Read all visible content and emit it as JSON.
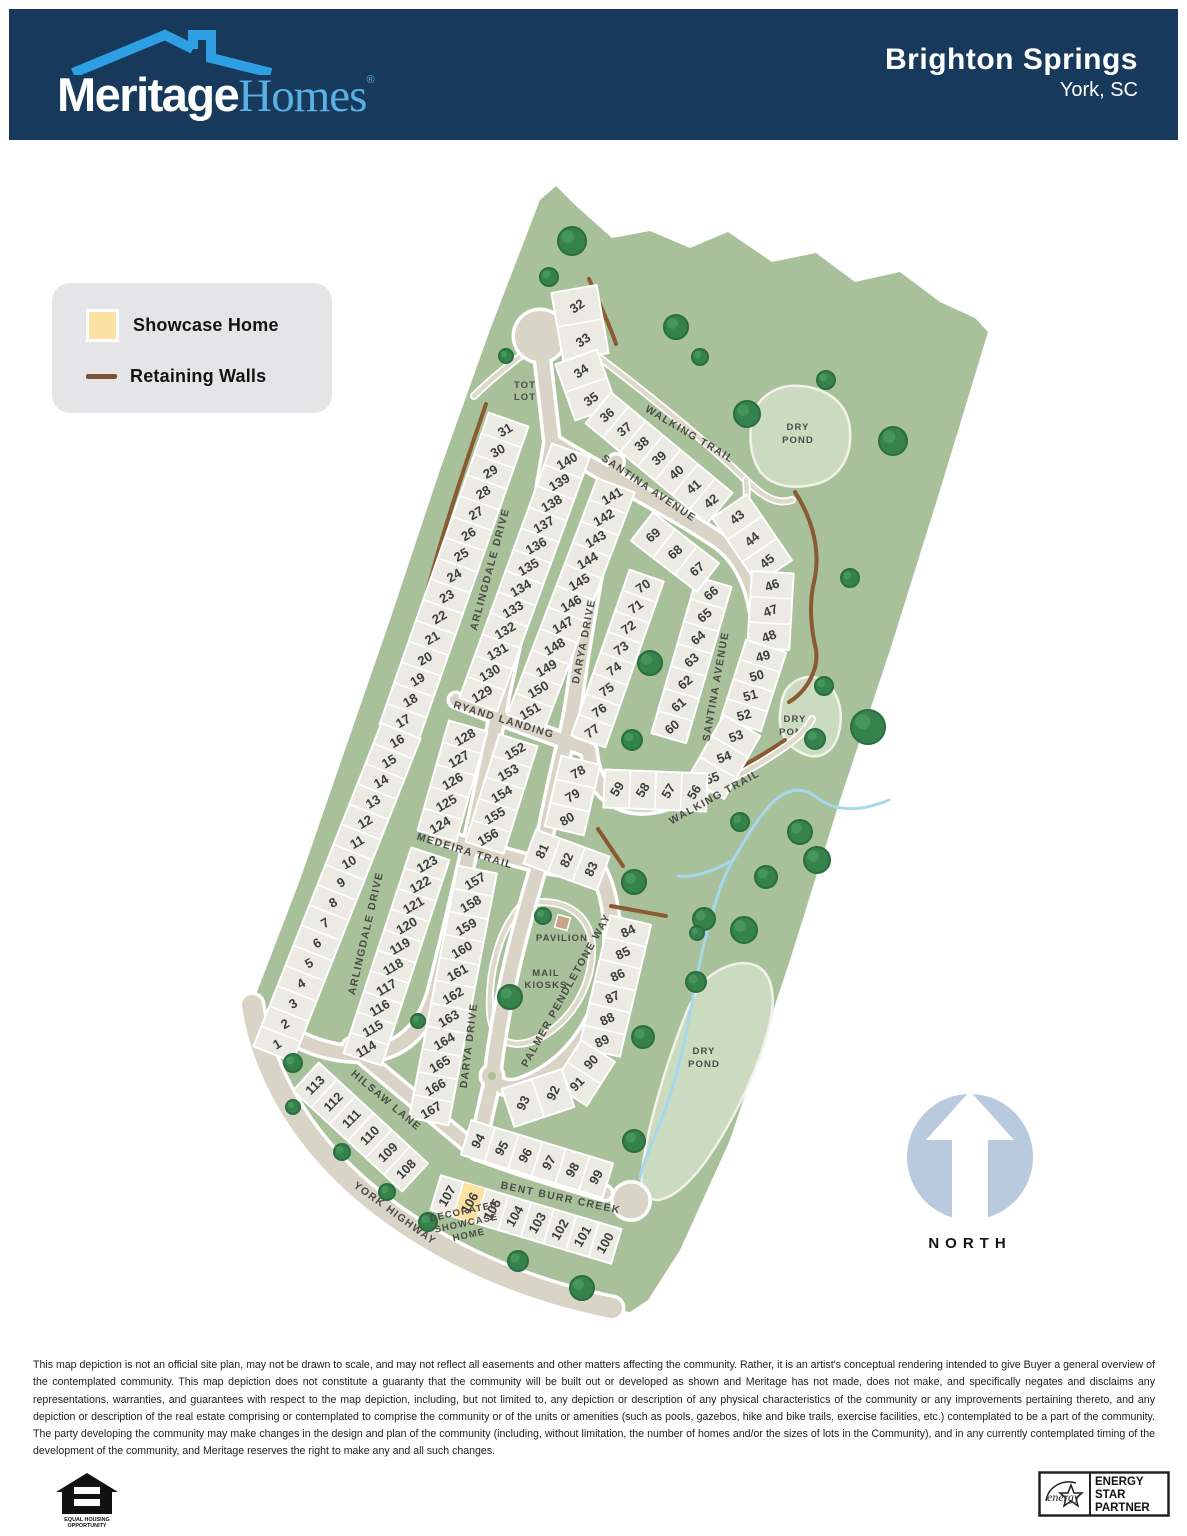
{
  "header": {
    "brand_bold": "Meritage",
    "brand_serif": "Homes",
    "brand_reg": "®",
    "community": "Brighton Springs",
    "location": "York, SC"
  },
  "legend": {
    "showcase_label": "Showcase Home",
    "walls_label": "Retaining Walls"
  },
  "north_label": "NORTH",
  "disclaimer": "This map depiction is not an official site plan, may not be drawn to scale, and may not reflect all easements and other matters affecting the community. Rather, it is an artist's conceptual rendering intended to give Buyer a general overview of the contemplated community. This map depiction does not constitute a guaranty that the community will be built out or developed as shown and Meritage has not made, does not make, and specifically negates and disclaims any representations, warranties, and guarantees with respect to the map depiction, including, but not limited to, any depiction or description of any physical characteristics of the community or any improvements pertaining thereto, and any depiction or description of the real estate comprising or contemplated to comprise the community or of the units or amenities (such as pools, gazebos, hike and bike trails, exercise facilities, etc.) contemplated to be a part of the community. The party developing the community may make changes in the design and plan of the community (including, without limitation, the number of homes and/or the sizes of lots in the Community), and in any currently contemplated timing of the development of the community, and Meritage reserves the right to make any and all such changes.",
  "footer": {
    "eho_line1": "EQUAL HOUSING",
    "eho_line2": "OPPORTUNITY",
    "estar_script": "energy",
    "estar_lines": [
      "ENERGY",
      "STAR",
      "PARTNER"
    ]
  },
  "colors": {
    "header_navy": "#17395c",
    "roof_blue": "#2d9fe2",
    "green": "#a8c19a",
    "pond": "#cbdbbf",
    "pond_edge": "#f3f2ea",
    "road": "#d9d4c5",
    "road_edge": "#ffffff",
    "lot": "#ebeae3",
    "lot_edge": "#ffffff",
    "wall": "#8a5a33",
    "creek": "#a5d8ec",
    "tree": "#35824d",
    "tree_edge": "#2a6e40",
    "showcase": "#fbe2a2",
    "north_circle": "#b9cadf",
    "pavilion": "#c9a486"
  },
  "map": {
    "boundary": [
      [
        556,
        186
      ],
      [
        575,
        205
      ],
      [
        612,
        238
      ],
      [
        650,
        231
      ],
      [
        690,
        248
      ],
      [
        728,
        232
      ],
      [
        772,
        262
      ],
      [
        816,
        253
      ],
      [
        855,
        282
      ],
      [
        900,
        272
      ],
      [
        940,
        302
      ],
      [
        975,
        318
      ],
      [
        988,
        332
      ],
      [
        940,
        490
      ],
      [
        890,
        650
      ],
      [
        840,
        800
      ],
      [
        790,
        960
      ],
      [
        730,
        1140
      ],
      [
        680,
        1250
      ],
      [
        648,
        1300
      ],
      [
        630,
        1312
      ],
      [
        560,
        1300
      ],
      [
        470,
        1256
      ],
      [
        390,
        1204
      ],
      [
        328,
        1152
      ],
      [
        282,
        1092
      ],
      [
        256,
        1028
      ],
      [
        252,
        1005
      ],
      [
        300,
        880
      ],
      [
        345,
        750
      ],
      [
        390,
        620
      ],
      [
        440,
        470
      ],
      [
        490,
        330
      ],
      [
        540,
        200
      ]
    ],
    "ponds": [
      {
        "d": "M752,420 C756,396 778,384 800,386 C826,388 848,402 850,430 C852,456 840,478 816,484 C792,490 768,486 758,468 C750,454 749,436 752,420 Z",
        "label": [
          "DRY",
          "POND"
        ],
        "lx": 798,
        "ly": 430
      },
      {
        "d": "M786,690 C796,676 816,672 828,684 C840,696 844,716 838,736 C832,754 818,760 804,754 C788,748 778,732 780,714 C781,705 782,696 786,690 Z",
        "label": [
          "DRY",
          "POND"
        ],
        "lx": 795,
        "ly": 722
      },
      {
        "d": "M700,986 C715,968 740,958 757,966 C772,974 776,996 770,1022 C760,1065 738,1112 712,1152 C695,1178 675,1198 658,1200 C646,1200 640,1190 642,1172 C646,1135 660,1085 676,1040 C683,1020 690,1002 700,986 Z",
        "label": [
          "DRY",
          "POND"
        ],
        "lx": 704,
        "ly": 1054
      }
    ],
    "creeks": [
      "M889,800 C860,812 835,812 816,797 C800,785 784,790 770,805 C755,822 745,840 733,860 C720,883 713,910 705,940 C697,972 692,1005 685,1038 C678,1072 668,1105 654,1138 C648,1152 643,1165 640,1178",
      "M733,860 C712,872 694,878 678,876"
    ],
    "trails": [
      "M600,358 C650,396 700,436 746,480 C763,497 777,505 792,500",
      "M746,480 C748,497 746,510 740,521",
      "M640,812 C688,801 738,780 786,746 C800,736 808,727 812,719",
      "M522,355 C505,368 490,380 474,396",
      "M522,905 C560,895 590,912 592,945 C594,985 570,1025 535,1040 C510,1050 492,1040 490,1012 C488,975 498,930 522,905"
    ],
    "roads": [
      {
        "d": "M252,1005 C262,1072 300,1136 356,1186 C420,1243 510,1288 612,1308",
        "w": 20
      },
      {
        "d": "M540,338 L552,442 C540,520 522,600 502,692 C484,786 462,888 438,982 C430,1020 410,1045 380,1052 C350,1058 320,1050 300,1040",
        "w": 13
      },
      {
        "d": "M552,442 C610,478 670,508 718,540 C752,564 764,612 759,666 C753,718 728,764 688,791 C660,809 628,812 606,792 C594,780 590,765 589,751",
        "w": 13
      },
      {
        "d": "M616,462 C600,540 585,620 574,700 C570,725 566,742 562,757 C552,800 546,830 540,862 C522,922 506,982 497,1042 C494,1060 493,1070 493,1078 L483,1122 L477,1152",
        "w": 13
      },
      {
        "d": "M456,700 C500,718 546,734 589,750",
        "w": 12
      },
      {
        "d": "M438,836 C475,847 510,858 541,865 C562,869 582,871 599,872",
        "w": 12
      },
      {
        "d": "M599,872 C614,903 617,948 604,994 C590,1040 560,1072 521,1086 C509,1090 499,1087 493,1080",
        "w": 13
      },
      {
        "d": "M350,1046 L477,1152",
        "w": 12
      },
      {
        "d": "M477,1152 C520,1168 560,1180 605,1193",
        "w": 12
      }
    ],
    "culdesacs": [
      {
        "cx": 540,
        "cy": 336,
        "r": 25
      },
      {
        "cx": 631,
        "cy": 1201,
        "r": 17.5
      },
      {
        "cx": 492,
        "cy": 1076,
        "r": 10,
        "hole": 4
      }
    ],
    "walls": [
      "M589,279 C600,305 611,328 616,344",
      "M486,404 C458,485 432,565 414,645 C398,710 377,790 353,848 L331,878",
      "M795,492 C813,520 821,552 814,582 C809,603 811,628 816,650 C819,670 806,692 789,702",
      "M640,806 C688,794 737,773 785,740",
      "M598,829 L623,866",
      "M611,906 L666,916"
    ],
    "strips": [
      {
        "lots": [
          "32",
          "33"
        ],
        "x1": 577,
        "y1": 306,
        "x2": 583,
        "y2": 340,
        "w": 46,
        "ang": -35
      },
      {
        "lots": [
          "34",
          "35"
        ],
        "x1": 581,
        "y1": 371,
        "x2": 591,
        "y2": 399,
        "w": 44,
        "ang": -35
      },
      {
        "lots": [
          "36",
          "37",
          "38",
          "39",
          "40",
          "41",
          "42"
        ],
        "x1": 607,
        "y1": 415,
        "x2": 711,
        "y2": 501,
        "w": 40,
        "ang": -40
      },
      {
        "lots": [
          "43",
          "44",
          "45"
        ],
        "x1": 737,
        "y1": 517,
        "x2": 767,
        "y2": 561,
        "w": 42,
        "ang": -40
      },
      {
        "lots": [
          "46",
          "47",
          "48"
        ],
        "x1": 772,
        "y1": 585,
        "x2": 769,
        "y2": 636,
        "w": 42,
        "ang": -20
      },
      {
        "lots": [
          "49",
          "50",
          "51",
          "52"
        ],
        "x1": 763,
        "y1": 656,
        "x2": 744,
        "y2": 715,
        "w": 42,
        "ang": -15
      },
      {
        "lots": [
          "53",
          "54",
          "55"
        ],
        "x1": 736,
        "y1": 736,
        "x2": 712,
        "y2": 778,
        "w": 42,
        "ang": -20
      },
      {
        "lots": [
          "56",
          "57",
          "58",
          "59"
        ],
        "x1": 694,
        "y1": 792,
        "x2": 617,
        "y2": 789,
        "w": 38,
        "ang": -58
      },
      {
        "lots": [
          "66",
          "65",
          "64",
          "63",
          "62",
          "61",
          "60"
        ],
        "x1": 711,
        "y1": 593,
        "x2": 672,
        "y2": 727,
        "w": 36,
        "ang": -40
      },
      {
        "lots": [
          "69",
          "68",
          "67"
        ],
        "x1": 653,
        "y1": 535,
        "x2": 697,
        "y2": 569,
        "w": 36,
        "ang": -40
      },
      {
        "lots": [
          "70",
          "71",
          "72",
          "73",
          "74",
          "75",
          "76",
          "77"
        ],
        "x1": 643,
        "y1": 586,
        "x2": 592,
        "y2": 731,
        "w": 36,
        "ang": -35
      },
      {
        "lots": [
          "140",
          "139",
          "138",
          "137",
          "136",
          "135",
          "134",
          "133",
          "132",
          "131",
          "130",
          "129"
        ],
        "x1": 567,
        "y1": 461,
        "x2": 482,
        "y2": 694,
        "w": 40,
        "ang": -30
      },
      {
        "lots": [
          "141",
          "142",
          "143",
          "144",
          "145",
          "146",
          "147",
          "148",
          "149",
          "150",
          "151"
        ],
        "x1": 612,
        "y1": 496,
        "x2": 530,
        "y2": 711,
        "w": 40,
        "ang": -30
      },
      {
        "lots": [
          "31",
          "30",
          "29",
          "28",
          "27",
          "26",
          "25",
          "24",
          "23",
          "22",
          "21",
          "20",
          "19",
          "18",
          "17"
        ],
        "x1": 505,
        "y1": 430,
        "x2": 403,
        "y2": 721,
        "w": 42,
        "ang": -30
      },
      {
        "lots": [
          "16",
          "15",
          "14",
          "13",
          "12",
          "11",
          "10",
          "9",
          "8",
          "7",
          "6",
          "5",
          "4",
          "3",
          "2",
          "1"
        ],
        "x1": 397,
        "y1": 741,
        "x2": 277,
        "y2": 1044,
        "w": 42,
        "ang": -30
      },
      {
        "lots": [
          "128",
          "127",
          "126",
          "125",
          "124"
        ],
        "x1": 465,
        "y1": 737,
        "x2": 440,
        "y2": 825,
        "w": 40,
        "ang": -30
      },
      {
        "lots": [
          "152",
          "153",
          "154",
          "155",
          "156"
        ],
        "x1": 515,
        "y1": 751,
        "x2": 488,
        "y2": 837,
        "w": 40,
        "ang": -30
      },
      {
        "lots": [
          "123",
          "122",
          "121",
          "120",
          "119",
          "118",
          "117",
          "116",
          "115",
          "114"
        ],
        "x1": 427,
        "y1": 864,
        "x2": 366,
        "y2": 1049,
        "w": 40,
        "ang": -30
      },
      {
        "lots": [
          "157",
          "158",
          "159",
          "160",
          "161",
          "162",
          "163",
          "164",
          "165",
          "166",
          "167"
        ],
        "x1": 475,
        "y1": 881,
        "x2": 431,
        "y2": 1110,
        "w": 40,
        "ang": -30
      },
      {
        "lots": [
          "78",
          "79",
          "80"
        ],
        "x1": 578,
        "y1": 772,
        "x2": 567,
        "y2": 819,
        "w": 40,
        "ang": -30
      },
      {
        "lots": [
          "81",
          "82",
          "83"
        ],
        "x1": 542,
        "y1": 851,
        "x2": 591,
        "y2": 869,
        "w": 36,
        "ang": -65
      },
      {
        "lots": [
          "84",
          "85",
          "86",
          "87",
          "88",
          "89"
        ],
        "x1": 628,
        "y1": 931,
        "x2": 602,
        "y2": 1041,
        "w": 42,
        "ang": -25
      },
      {
        "lots": [
          "90",
          "91"
        ],
        "x1": 591,
        "y1": 1062,
        "x2": 577,
        "y2": 1084,
        "w": 40,
        "ang": -45
      },
      {
        "lots": [
          "92",
          "93"
        ],
        "x1": 553,
        "y1": 1093,
        "x2": 523,
        "y2": 1103,
        "w": 40,
        "ang": -65
      },
      {
        "lots": [
          "94",
          "95",
          "96",
          "97",
          "98",
          "99"
        ],
        "x1": 478,
        "y1": 1141,
        "x2": 596,
        "y2": 1177,
        "w": 36,
        "ang": -60
      },
      {
        "lots": [
          "107",
          "106",
          "105",
          "104",
          "103",
          "102",
          "101",
          "100"
        ],
        "x1": 447,
        "y1": 1196,
        "x2": 605,
        "y2": 1243,
        "w": 36,
        "ang": -60,
        "hl": "106"
      },
      {
        "lots": [
          "113",
          "112",
          "111",
          "110",
          "109",
          "108"
        ],
        "x1": 315,
        "y1": 1085,
        "x2": 406,
        "y2": 1169,
        "w": 38,
        "ang": -45
      }
    ],
    "street_labels": [
      {
        "t": "ARLINGDALE DRIVE",
        "x": 493,
        "y": 570,
        "r": -75
      },
      {
        "t": "ARLINGDALE DRIVE",
        "x": 369,
        "y": 934,
        "r": -77
      },
      {
        "t": "SANTINA AVENUE",
        "x": 647,
        "y": 491,
        "r": 34
      },
      {
        "t": "SANTINA AVENUE",
        "x": 719,
        "y": 687,
        "r": -80
      },
      {
        "t": "DARYA DRIVE",
        "x": 587,
        "y": 642,
        "r": -79
      },
      {
        "t": "DARYA DRIVE",
        "x": 472,
        "y": 1046,
        "r": -83
      },
      {
        "t": "RYAND LANDING",
        "x": 503,
        "y": 723,
        "r": 17
      },
      {
        "t": "MEDEIRA TRAIL",
        "x": 464,
        "y": 854,
        "r": 17
      },
      {
        "t": "PALMER PENDLETONE WAY",
        "x": 569,
        "y": 992,
        "r": -61
      },
      {
        "t": "HILSAW LANE",
        "x": 384,
        "y": 1103,
        "r": 40
      },
      {
        "t": "YORK HIGHWAY",
        "x": 393,
        "y": 1216,
        "r": 36
      },
      {
        "t": "BENT BURR CREEK",
        "x": 560,
        "y": 1201,
        "r": 12
      },
      {
        "t": "WALKING TRAIL",
        "x": 688,
        "y": 437,
        "r": 31
      },
      {
        "t": "WALKING TRAIL",
        "x": 716,
        "y": 800,
        "r": -29
      }
    ],
    "amenity_labels": [
      {
        "lines": [
          "TOT",
          "LOT"
        ],
        "x": 525,
        "y": 394,
        "r": 0
      },
      {
        "lines": [
          "PAVILION"
        ],
        "x": 562,
        "y": 941,
        "r": 0
      },
      {
        "lines": [
          "MAIL",
          "KIOSKS"
        ],
        "x": 546,
        "y": 982,
        "r": 0
      },
      {
        "lines": [
          "DECORATED",
          "SHOWCASE",
          "HOME"
        ],
        "x": 467,
        "y": 1226,
        "r": -12,
        "fs": 8.5
      }
    ],
    "trees": [
      [
        572,
        241,
        14
      ],
      [
        549,
        277,
        9
      ],
      [
        676,
        327,
        12
      ],
      [
        700,
        357,
        8
      ],
      [
        747,
        414,
        13
      ],
      [
        826,
        380,
        9
      ],
      [
        893,
        441,
        14
      ],
      [
        506,
        356,
        7
      ],
      [
        850,
        578,
        9
      ],
      [
        650,
        663,
        12
      ],
      [
        632,
        740,
        10
      ],
      [
        868,
        727,
        17
      ],
      [
        824,
        686,
        9
      ],
      [
        815,
        739,
        10
      ],
      [
        740,
        822,
        9
      ],
      [
        800,
        832,
        12
      ],
      [
        817,
        860,
        13
      ],
      [
        766,
        877,
        11
      ],
      [
        634,
        882,
        12
      ],
      [
        704,
        919,
        11
      ],
      [
        744,
        930,
        13
      ],
      [
        696,
        982,
        10
      ],
      [
        643,
        1037,
        11
      ],
      [
        634,
        1141,
        11
      ],
      [
        697,
        933,
        7
      ],
      [
        510,
        997,
        12
      ],
      [
        543,
        916,
        8
      ],
      [
        418,
        1021,
        7
      ],
      [
        428,
        1222,
        9
      ],
      [
        518,
        1261,
        10
      ],
      [
        582,
        1288,
        12
      ],
      [
        342,
        1152,
        8
      ],
      [
        293,
        1107,
        7
      ],
      [
        387,
        1192,
        8
      ],
      [
        293,
        1063,
        9
      ]
    ],
    "pavilion": {
      "x": 556,
      "y": 916,
      "s": 13,
      "r": 15
    },
    "north": {
      "cx": 970,
      "cy": 1157,
      "r": 63,
      "tx": 970,
      "ty": 1248
    }
  }
}
